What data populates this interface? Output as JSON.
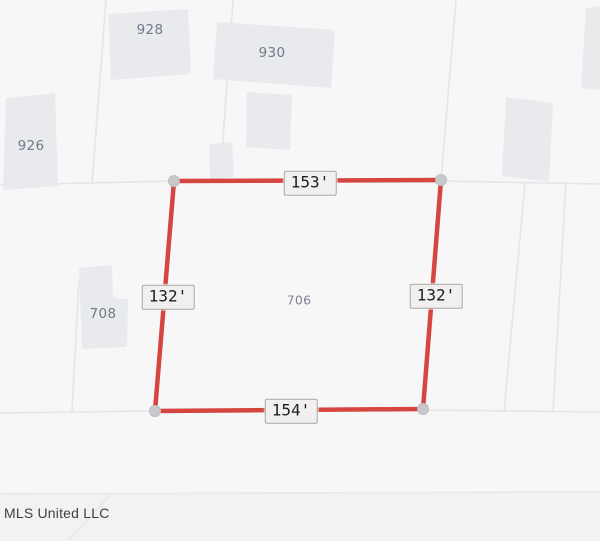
{
  "canvas": {
    "width": 600,
    "height": 541
  },
  "colors": {
    "background": "#f7f7f8",
    "road_fill": "#f2f2f4",
    "lot_line": "#e4e5e8",
    "road_line": "#e9eaec",
    "building_fill": "#e8eaee",
    "parcel_line": "#d6453f",
    "corner_marker_fill": "#c8c9cd",
    "corner_marker_stroke": "#bcbdc0"
  },
  "parcel": {
    "corners": [
      [
        174,
        181
      ],
      [
        441,
        180
      ],
      [
        423,
        409
      ],
      [
        155,
        411
      ]
    ],
    "line_width": 4.5,
    "marker_radius": 5.5,
    "dimensions": [
      {
        "text": "153'",
        "x": 310,
        "y": 183
      },
      {
        "text": "132'",
        "x": 168,
        "y": 297
      },
      {
        "text": "132'",
        "x": 436,
        "y": 296
      },
      {
        "text": "154'",
        "x": 291,
        "y": 411
      }
    ],
    "number": {
      "text": "706",
      "x": 299,
      "y": 300
    }
  },
  "buildings": [
    {
      "name": "building-928",
      "points": [
        [
          108,
          14
        ],
        [
          188,
          9
        ],
        [
          191,
          74
        ],
        [
          111,
          80
        ]
      ]
    },
    {
      "name": "building-930",
      "points": [
        [
          217,
          22
        ],
        [
          335,
          30
        ],
        [
          331,
          88
        ],
        [
          213,
          79
        ]
      ]
    },
    {
      "name": "building-926",
      "points": [
        [
          6,
          98
        ],
        [
          55,
          93
        ],
        [
          58,
          186
        ],
        [
          3,
          190
        ]
      ]
    },
    {
      "name": "building-small-mid",
      "points": [
        [
          247,
          92
        ],
        [
          292,
          95
        ],
        [
          290,
          150
        ],
        [
          246,
          147
        ]
      ]
    },
    {
      "name": "building-small-lower",
      "points": [
        [
          209,
          144
        ],
        [
          232,
          142
        ],
        [
          234,
          177
        ],
        [
          210,
          179
        ]
      ]
    },
    {
      "name": "building-708",
      "points": [
        [
          79,
          268
        ],
        [
          112,
          265
        ],
        [
          113,
          298
        ],
        [
          128,
          299
        ],
        [
          127,
          347
        ],
        [
          82,
          349
        ]
      ]
    },
    {
      "name": "building-right",
      "points": [
        [
          506,
          97
        ],
        [
          553,
          103
        ],
        [
          549,
          182
        ],
        [
          502,
          176
        ]
      ]
    },
    {
      "name": "building-top-right",
      "points": [
        [
          586,
          8
        ],
        [
          600,
          6
        ],
        [
          600,
          90
        ],
        [
          581,
          88
        ]
      ]
    }
  ],
  "building_labels": [
    {
      "text": "928",
      "x": 150,
      "y": 30
    },
    {
      "text": "930",
      "x": 272,
      "y": 53
    },
    {
      "text": "926",
      "x": 31,
      "y": 146
    },
    {
      "text": "708",
      "x": 103,
      "y": 314
    }
  ],
  "lot_lines": [
    {
      "points": [
        [
          106,
          0
        ],
        [
          92,
          184
        ]
      ]
    },
    {
      "points": [
        [
          233,
          0
        ],
        [
          220,
          180
        ]
      ]
    },
    {
      "points": [
        [
          456,
          0
        ],
        [
          441,
          180
        ]
      ]
    },
    {
      "points": [
        [
          0,
          185
        ],
        [
          174,
          181
        ]
      ]
    },
    {
      "points": [
        [
          0,
          413
        ],
        [
          155,
          411
        ]
      ]
    },
    {
      "points": [
        [
          79,
          280
        ],
        [
          72,
          411
        ]
      ]
    },
    {
      "points": [
        [
          525,
          183
        ],
        [
          504,
          412
        ]
      ]
    },
    {
      "points": [
        [
          566,
          181
        ],
        [
          553,
          412
        ]
      ]
    },
    {
      "points": [
        [
          441,
          181
        ],
        [
          600,
          184
        ]
      ]
    },
    {
      "points": [
        [
          423,
          410
        ],
        [
          600,
          412
        ]
      ]
    }
  ],
  "road": {
    "top_y": 493,
    "edge_line": [
      [
        0,
        494
      ],
      [
        600,
        492
      ]
    ],
    "diagonal_line": [
      [
        68,
        541
      ],
      [
        112,
        493
      ]
    ]
  },
  "attribution": {
    "text": "MLS United LLC"
  }
}
